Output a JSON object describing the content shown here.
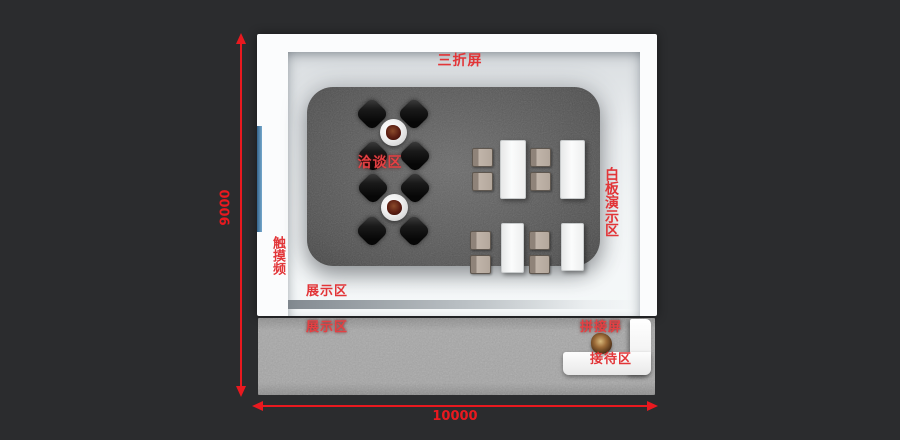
{
  "annotations": {
    "tri_fold_screen": "三折屏",
    "negotiation_area": "洽谈区",
    "whiteboard_demo_area": "白板演示区",
    "touch_screen": "触摸频",
    "display_area_inner": "展示区",
    "display_area_outer": "展示区",
    "splicing_screen": "拼接屏",
    "reception_area": "接待区"
  },
  "dimensions": {
    "vertical": "9000",
    "horizontal": "10000"
  },
  "colors": {
    "background": "#2b2c2e",
    "dimension_red": "#e9191f",
    "label_red": "#e23538",
    "carpet": "#6c6c6c",
    "concrete": "#a8a8a8",
    "touch_strip_blue": "#35638a",
    "desk": "#fdfdfd"
  },
  "furniture": {
    "round_tables": [
      {
        "cx": 393,
        "cy": 132
      },
      {
        "cx": 394,
        "cy": 207
      }
    ],
    "black_chairs": [
      {
        "cx": 372,
        "cy": 114
      },
      {
        "cx": 414,
        "cy": 114
      },
      {
        "cx": 373,
        "cy": 156
      },
      {
        "cx": 415,
        "cy": 156
      },
      {
        "cx": 373,
        "cy": 188
      },
      {
        "cx": 415,
        "cy": 188
      },
      {
        "cx": 372,
        "cy": 231
      },
      {
        "cx": 414,
        "cy": 231
      }
    ],
    "rect_tables": [
      {
        "x": 500,
        "y": 140,
        "w": 24,
        "h": 57
      },
      {
        "x": 560,
        "y": 140,
        "w": 23,
        "h": 57
      },
      {
        "x": 501,
        "y": 223,
        "w": 21,
        "h": 48
      },
      {
        "x": 561,
        "y": 223,
        "w": 21,
        "h": 46
      }
    ],
    "beige_chairs": [
      {
        "x": 472,
        "y": 148
      },
      {
        "x": 472,
        "y": 172
      },
      {
        "x": 530,
        "y": 148
      },
      {
        "x": 530,
        "y": 172
      },
      {
        "x": 470,
        "y": 231
      },
      {
        "x": 470,
        "y": 255
      },
      {
        "x": 529,
        "y": 231
      },
      {
        "x": 529,
        "y": 255
      }
    ]
  }
}
